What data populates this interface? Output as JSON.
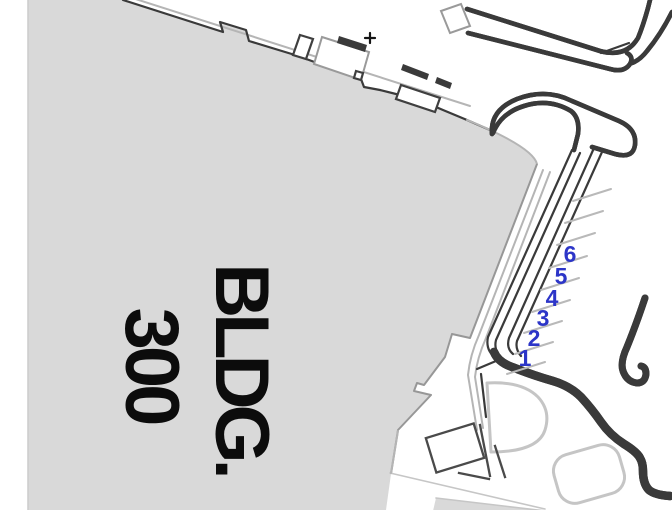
{
  "map": {
    "title": "site plan",
    "building": {
      "label_line1": "BLDG.",
      "label_line2": "300"
    },
    "parking": {
      "space_numbers": [
        "1",
        "2",
        "3",
        "4",
        "5",
        "6"
      ]
    },
    "markers": {
      "plus": "+"
    },
    "colors": {
      "building_fill": "#d9d9d9",
      "outline_dark": "#3a3a3a",
      "outline_light": "#b9b9b9",
      "parking_number_blue": "#2c35c8"
    }
  }
}
